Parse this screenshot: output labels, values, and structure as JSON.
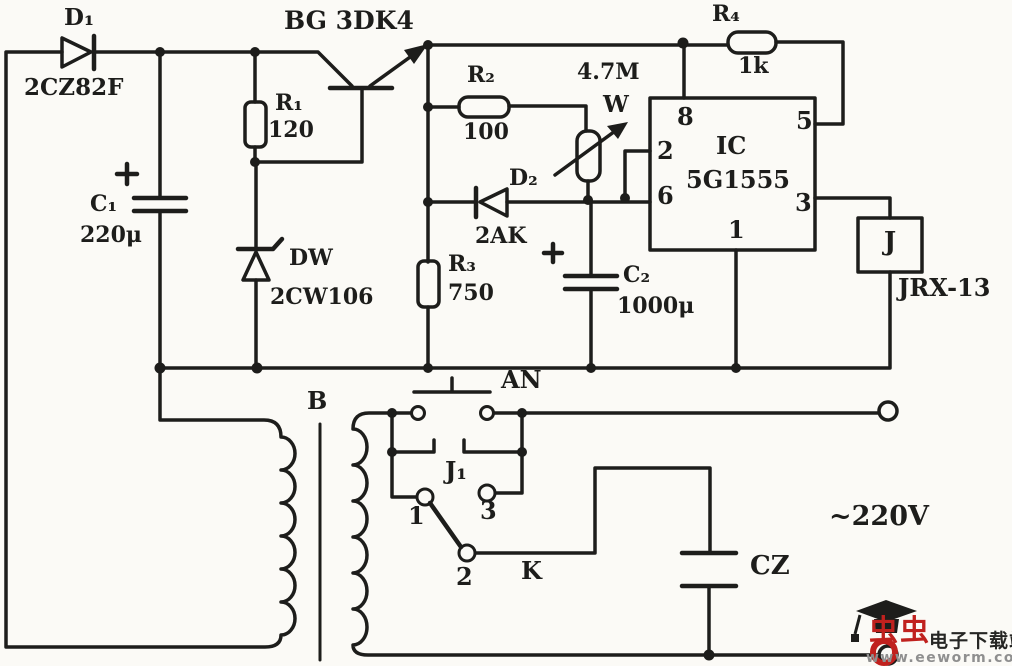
{
  "diagram_type": "schematic-circuit",
  "colors": {
    "ink": "#1d1d1b",
    "paper": "#fbfaf6",
    "logo_red": "#c0211e",
    "watermark_gray": "#8f8f8f"
  },
  "labels": {
    "d1_ref": "D₁",
    "d1_part": "2CZ82F",
    "transistor": "BG 3DK4",
    "r1_ref": "R₁",
    "r1_val": "120",
    "c1_ref": "C₁",
    "c1_val": "220μ",
    "dw_ref": "DW",
    "dw_part": "2CW106",
    "r2_ref": "R₂",
    "r2_val": "100",
    "w_val": "4.7M",
    "w_ref": "W",
    "d2_ref": "D₂",
    "d2_part": "2AK",
    "r3_ref": "R₃",
    "r3_val": "750",
    "c2_ref": "C₂",
    "c2_val": "1000μ",
    "r4_ref": "R₄",
    "r4_val": "1k",
    "ic_ref": "IC",
    "ic_part": "5G1555",
    "pin8": "8",
    "pin2": "2",
    "pin6": "6",
    "pin5": "5",
    "pin3": "3",
    "pin1": "1",
    "relay_ref": "J",
    "relay_part": "JRX-13",
    "pushbutton": "AN",
    "transformer": "B",
    "contact_ref": "J₁",
    "contact_1": "1",
    "contact_3": "3",
    "contact_2": "2",
    "switch_k": "K",
    "socket": "CZ",
    "mains": "~220V"
  },
  "watermark": {
    "logo_text": "虫虫",
    "site_name": "电子下载站",
    "url": "www.eeworm.com"
  }
}
